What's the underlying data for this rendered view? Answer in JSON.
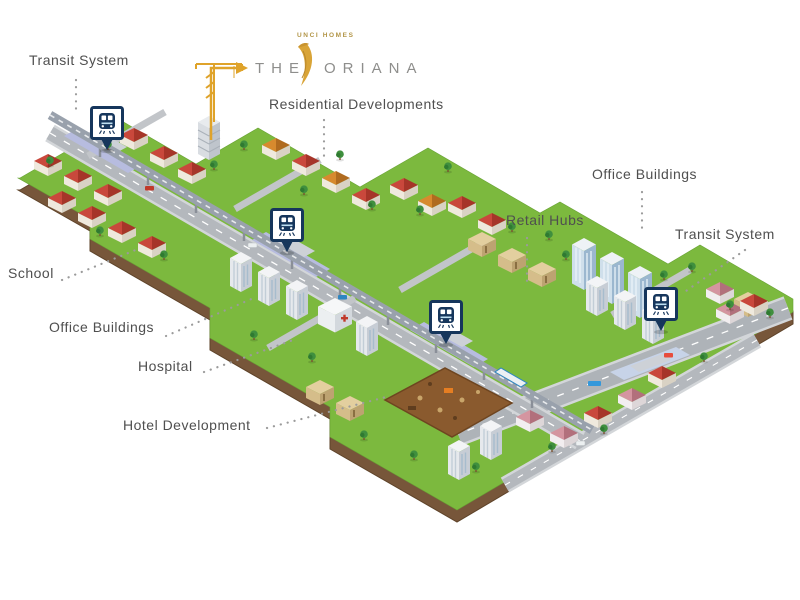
{
  "brand": {
    "developer": "UNCI HOMES",
    "name_first": "THE",
    "name_second": "ORIANA",
    "leaf_icon": "golden-leaf",
    "gold": "#D9A437",
    "text_color": "#8E8E8C"
  },
  "callouts": {
    "transit_top": "Transit System",
    "residential": "Residential Developments",
    "office_right": "Office Buildings",
    "retail": "Retail Hubs",
    "transit_right": "Transit System",
    "school": "School",
    "office_left": "Office Buildings",
    "hospital": "Hospital",
    "hotel": "Hotel Development"
  },
  "map": {
    "transit_marker_icon": "train-station-pin",
    "transit_marker_count": 4,
    "marker_color": "#16365C",
    "grass_color": "#7CB93E",
    "road_color": "#AEB3B8",
    "construction_plot_color": "#8A5A2E",
    "leader_line_color": "#9B9B9B",
    "arrow_color": "#DFA32A"
  }
}
